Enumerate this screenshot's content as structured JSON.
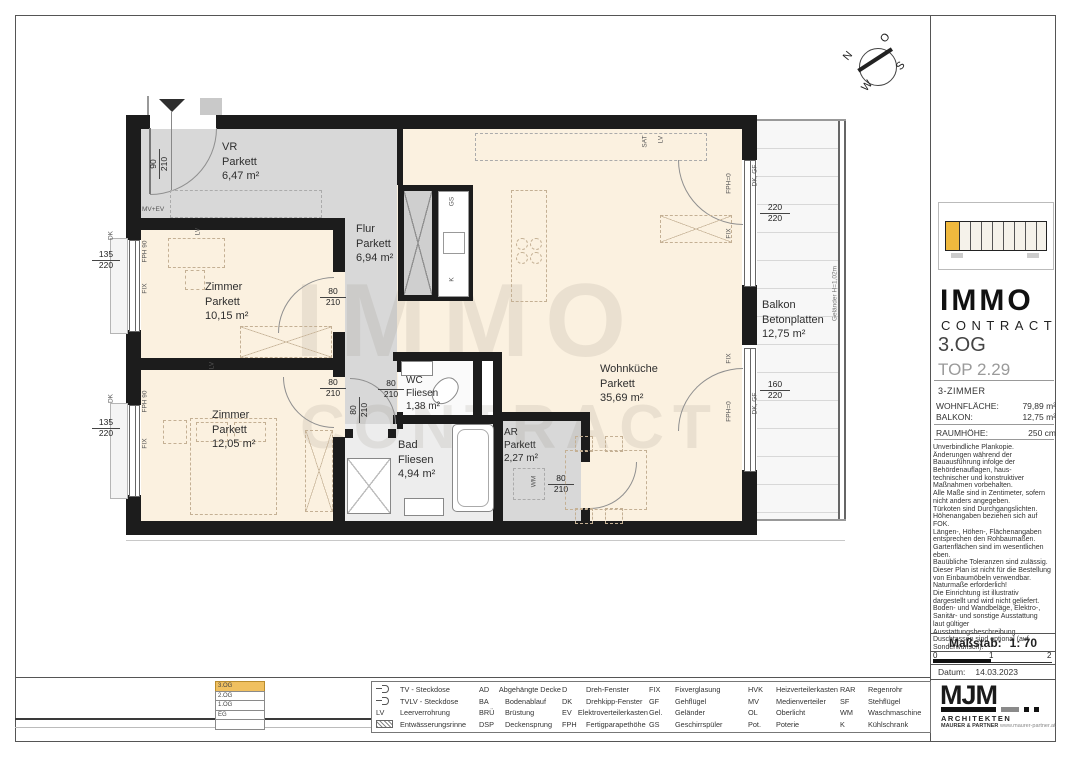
{
  "compass": {
    "n": "N",
    "o": "O",
    "s": "S",
    "w": "W"
  },
  "watermark": {
    "line1": "IMMO",
    "line2": "CONTRACT"
  },
  "rooms": [
    {
      "name": "VR",
      "floor": "Parkett",
      "area": "6,47 m²"
    },
    {
      "name": "Flur",
      "floor": "Parkett",
      "area": "6,94 m²"
    },
    {
      "name": "Zimmer",
      "floor": "Parkett",
      "area": "10,15 m²"
    },
    {
      "name": "Zimmer",
      "floor": "Parkett",
      "area": "12,05 m²"
    },
    {
      "name": "WC",
      "floor": "Fliesen",
      "area": "1,38 m²"
    },
    {
      "name": "Bad",
      "floor": "Fliesen",
      "area": "4,94 m²"
    },
    {
      "name": "AR",
      "floor": "Parkett",
      "area": "2,27 m²"
    },
    {
      "name": "Wohnküche",
      "floor": "Parkett",
      "area": "35,69 m²"
    },
    {
      "name": "Balkon",
      "floor": "Betonplatten",
      "area": "12,75 m²"
    }
  ],
  "dims": {
    "entrance": {
      "w": "90",
      "h": "210"
    },
    "window_left": {
      "w": "135",
      "h": "220"
    },
    "door_interior": {
      "w": "80",
      "h": "210"
    },
    "balcony_door_1": {
      "w": "220",
      "h": "220"
    },
    "balcony_door_2": {
      "w": "160",
      "h": "220"
    }
  },
  "tags": {
    "mv_ev": "MV+EV",
    "dk": "DK",
    "fph90": "FPH 90",
    "fix": "FIX",
    "lv": "LV",
    "sat": "SAT",
    "gs": "GS",
    "k": "K",
    "wm": "WM",
    "fph0": "FPH=0",
    "dk_gf": "DK, GF",
    "gelaender": "Geländer H=1,02m"
  },
  "sidebar": {
    "brand": {
      "line1": "IMMO",
      "line2": "CONTRACT"
    },
    "floor": "3.OG",
    "unit": "TOP 2.29",
    "type": "3-ZIMMER",
    "facts": [
      {
        "label": "WOHNFLÄCHE:",
        "value": "79,89 m²"
      },
      {
        "label": "BALKON:",
        "value": "12,75 m²"
      },
      {
        "label": "RAUMHÖHE:",
        "value": "250 cm"
      }
    ],
    "disclaimer": "Unverbindliche Plankopie.\nÄnderungen während der\nBauausführung infolge der\nBehördenauflagen, haus-\ntechnischer und konstruktiver\nMaßnahmen vorbehalten.\nAlle Maße sind in Zentimeter, sofern\nnicht anders angegeben.\nTürkoten sind Durchgangslichten.\nHöhenangaben beziehen sich auf\nFOK.\nLängen-, Höhen-, Flächenangaben\nentsprechen den Rohbaumaßen.\nGartenflächen sind im wesentlichen eben.\nBauübliche Toleranzen sind zulässig.\nDieser Plan ist nicht für die Bestellung\nvon Einbaumöbeln verwendbar.\nNaturmaße erforderlich!\nDie Einrichtung ist illustrativ\ndargestellt und wird nicht geliefert.\nBoden- und Wandbeläge, Elektro-,\nSanitär- und sonstige Ausstattung\nlaut gültiger\nAusstattungsbeschreibung.\nDuschtassen sind optional (auf\nSonderwunsch).",
    "scale_label": "Maßstab:",
    "scale_value": "1: 70",
    "scale_ticks": [
      "0",
      "1",
      "2"
    ],
    "date_label": "Datum:",
    "date_value": "14.03.2023",
    "architect": {
      "logo": "MJM",
      "line1": "ARCHITEKTEN",
      "line2": "MAURER & PARTNER",
      "url": "www.maurer-partner.at"
    }
  },
  "legend": {
    "cols": [
      [
        {
          "icon": "tv-socket-icon",
          "label": "TV - Steckdose"
        },
        {
          "icon": "tvlv-socket-icon",
          "label": "TVLV - Steckdose"
        },
        {
          "abbr": "LV",
          "label": "Leerverrohrung"
        },
        {
          "icon": "drain-channel-icon",
          "label": "Entwässerungsrinne"
        }
      ],
      [
        {
          "abbr": "AD",
          "label": "Abgehängte Decke"
        },
        {
          "abbr": "BA",
          "label": "Bodenablauf"
        },
        {
          "abbr": "BRÜ",
          "label": "Brüstung"
        },
        {
          "abbr": "DSP",
          "label": "Deckensprung"
        }
      ],
      [
        {
          "abbr": "D",
          "label": "Dreh-Fenster"
        },
        {
          "abbr": "DK",
          "label": "Drehkipp-Fenster"
        },
        {
          "abbr": "EV",
          "label": "Elektroverteilerkasten"
        },
        {
          "abbr": "FPH",
          "label": "Fertigparapethöhe"
        }
      ],
      [
        {
          "abbr": "FIX",
          "label": "Fixverglasung"
        },
        {
          "abbr": "GF",
          "label": "Gehflügel"
        },
        {
          "abbr": "Gel.",
          "label": "Geländer"
        },
        {
          "abbr": "GS",
          "label": "Geschirrspüler"
        }
      ],
      [
        {
          "abbr": "HVK",
          "label": "Heizverteilerkasten"
        },
        {
          "abbr": "MV",
          "label": "Medienverteiler"
        },
        {
          "abbr": "OL",
          "label": "Oberlicht"
        },
        {
          "abbr": "Pot.",
          "label": "Poterie"
        }
      ],
      [
        {
          "abbr": "RAR",
          "label": "Regenrohr"
        },
        {
          "abbr": "SF",
          "label": "Stehflügel"
        },
        {
          "abbr": "WM",
          "label": "Waschmaschine"
        },
        {
          "abbr": "K",
          "label": "Kühlschrank"
        }
      ]
    ]
  },
  "floors": {
    "items": [
      "3.OG",
      "2.OG",
      "1.OG",
      "EG",
      ""
    ]
  }
}
